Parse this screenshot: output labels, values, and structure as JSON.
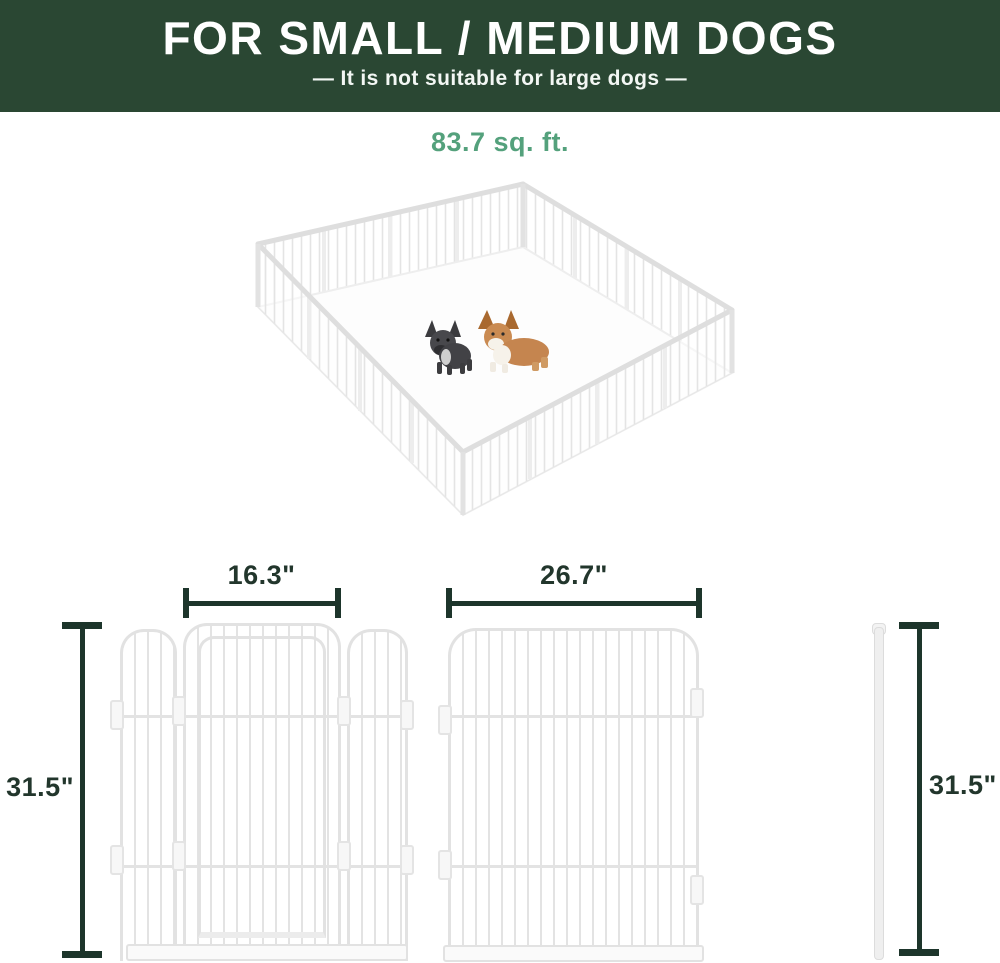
{
  "header": {
    "title": "FOR SMALL / MEDIUM DOGS",
    "subtitle": "—  It is not suitable for large dogs  —",
    "bg_color": "#2a4733",
    "text_color": "#ffffff"
  },
  "area_label": {
    "text": "83.7 sq. ft.",
    "color": "#54a17c"
  },
  "playpen_illustration": {
    "description": "isometric 16-panel white metal dog playpen, open top, viewed at angle",
    "panel_color": "#e3e3e3",
    "dogs": [
      {
        "name": "french-bulldog",
        "color": "#46464a"
      },
      {
        "name": "corgi",
        "color": "#c5854f",
        "accent_color": "#f6f2ea"
      }
    ]
  },
  "dimension_drawings": {
    "line_color": "#1d352b",
    "gate_panel_width": "16.3\"",
    "large_panel_width": "26.7\"",
    "gate_panel_height": "31.5\"",
    "rod_height": "31.5\""
  }
}
